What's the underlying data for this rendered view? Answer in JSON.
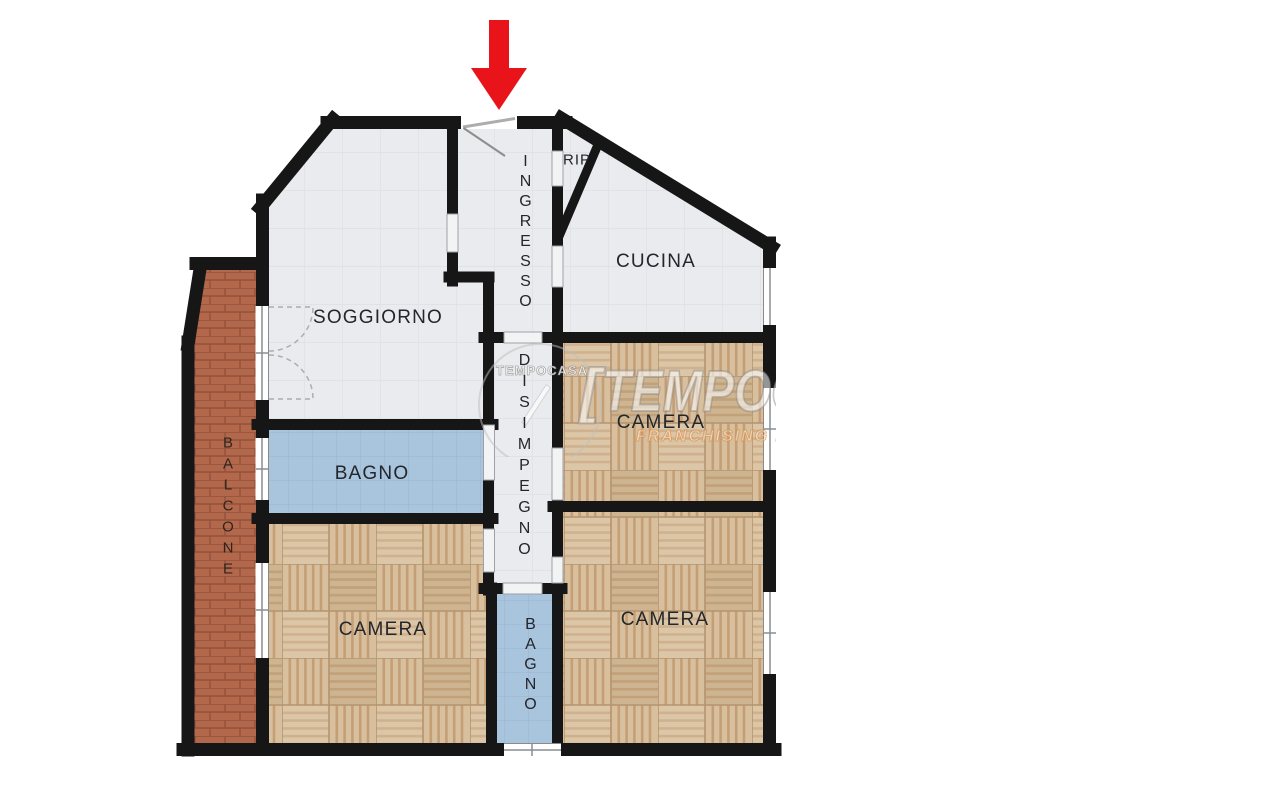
{
  "plan": {
    "labels": {
      "soggiorno": "SOGGIORNO",
      "ingresso": "INGRESSO",
      "rip": "RIP",
      "cucina": "CUCINA",
      "camera_nord": "CAMERA",
      "bagno_giorno": "BAGNO",
      "disimpegno": "DISIMPEGNO",
      "camera_ovest": "CAMERA",
      "camera_sud": "CAMERA",
      "bagno_notte": "BAGNO",
      "balcone": "BALCONE"
    },
    "colors": {
      "wall": "#161616",
      "floor_tile": "#EAEBEE",
      "floor_bath": "#A9C4DD",
      "floor_parquet": "#D5BC99",
      "floor_balcony_brick": "#B4684B",
      "entrance_arrow": "#E8141A"
    }
  },
  "watermark": {
    "brand": "TEMPOCASA",
    "tagline": "FRANCHISING NETWORK",
    "logo_text": "TEMPOCASA",
    "bracket": "["
  }
}
